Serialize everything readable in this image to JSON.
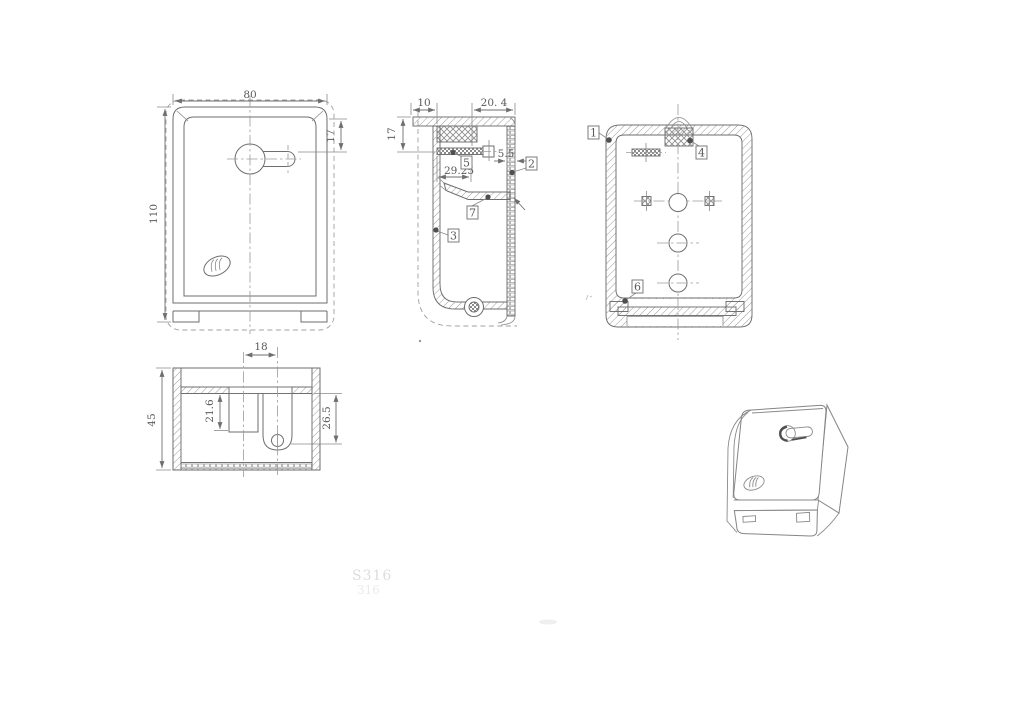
{
  "drawing": {
    "background": "#ffffff",
    "line_color": "#6e6e6e",
    "hatch_color": "#9a9a9a",
    "text_color": "#5a5a5a",
    "front_view": {
      "width": "80",
      "height": "110",
      "keyhole_offset": "17"
    },
    "side_view": {
      "top_left_width": "10",
      "top_right_width": "20. 4",
      "upper_height": "17",
      "shelf_width": "29.25",
      "wall_thickness": "5.5",
      "callouts": {
        "c2": "2",
        "c3": "3",
        "c5": "5",
        "c7": "7"
      }
    },
    "back_view": {
      "callouts": {
        "c1": "1",
        "c4": "4",
        "c6": "6"
      }
    },
    "top_view": {
      "slot_spacing": "18",
      "depth": "45",
      "pocket_depth": "21.6",
      "slot_depth": "26.5"
    },
    "watermark": {
      "line1": "S316",
      "line2": "316"
    }
  }
}
